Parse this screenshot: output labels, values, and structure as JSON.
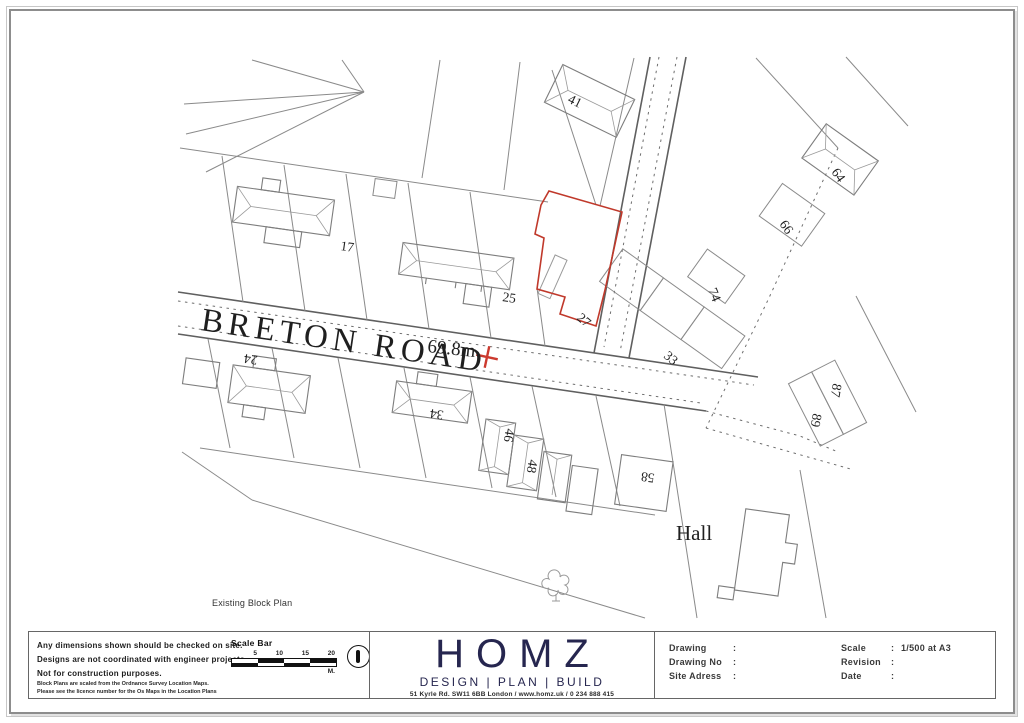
{
  "page": {
    "background": "#ffffff",
    "frame_color": "#8d8d8d",
    "accent_red": "#c0392b",
    "brand_navy": "#26264f"
  },
  "map": {
    "caption": "Existing Block Plan",
    "road_name": "BRETON ROAD",
    "spot_height": "69.8m",
    "hall": "Hall",
    "houses": {
      "h41": "41",
      "h17": "17",
      "h25": "25",
      "h27": "27",
      "h33": "33",
      "h74": "74",
      "h66": "66",
      "h64": "64",
      "h24": "24",
      "h34": "34",
      "h46": "46",
      "h48": "48",
      "h58": "58",
      "h87": "87",
      "h89": "89"
    }
  },
  "title_block": {
    "notes": {
      "line1": "Any dimensions shown should be checked on site.",
      "line2": "Designs are not coordinated with engineer projects.",
      "line3": "Not for construction purposes.",
      "fine1": "Block Plans are scaled from the Ordnance Survey Location Maps.",
      "fine2": "Please see the licence number for the Os Maps in the Location Plans"
    },
    "scale_bar": {
      "label": "Scale Bar",
      "ticks": [
        "5",
        "10",
        "15",
        "20"
      ],
      "unit": "M."
    },
    "brand": {
      "name": "HOMZ",
      "tagline": "DESIGN | PLAN | BUILD",
      "address": "51 Kyrle Rd. SW11 6BB London / www.homz.uk / 0 234 888 415"
    },
    "info": {
      "colon": ":",
      "drawing_label": "Drawing",
      "drawing_value": "",
      "drawing_no_label": "Drawing No",
      "drawing_no_value": "",
      "site_address_label": "Site Adress",
      "site_address_value": "",
      "scale_label": "Scale",
      "scale_value": "1/500 at A3",
      "revision_label": "Revision",
      "revision_value": "",
      "date_label": "Date",
      "date_value": ""
    }
  }
}
